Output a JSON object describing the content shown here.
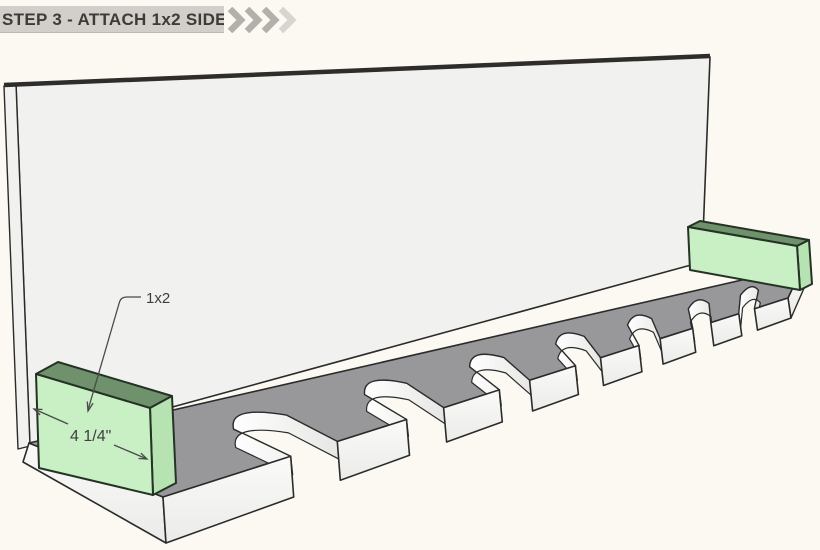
{
  "header": {
    "step_label": "STEP 3 - ATTACH 1x2 SIDES"
  },
  "annotations": {
    "part_label": "1x2",
    "dimension_label": "4 1/4\""
  },
  "illustration": {
    "description": "3D assembly view: slotted base board with back panel; two green 1x2 side pieces attached at left and right ends",
    "slot_count": 7,
    "finger_count": 8
  },
  "colors": {
    "background": "#fbf9f2",
    "banner_bg": "#d2cfca",
    "banner_text": "#3d3a37",
    "chevron": "#b3b0ac",
    "chevron_light": "#d8d5d1",
    "panel_face": "#f1f1f0",
    "board_top": "#98989a",
    "board_face_light": "#fafaf9",
    "board_face_dark": "#ebebe9",
    "wall_light": "#ffffff",
    "wall_dark": "#e6e6e4",
    "outline": "#2b2b2b",
    "green_front": "#c9efc5",
    "green_top": "#6f916b",
    "green_side": "#b7e3b2",
    "annotation": "#4a4a4a"
  }
}
